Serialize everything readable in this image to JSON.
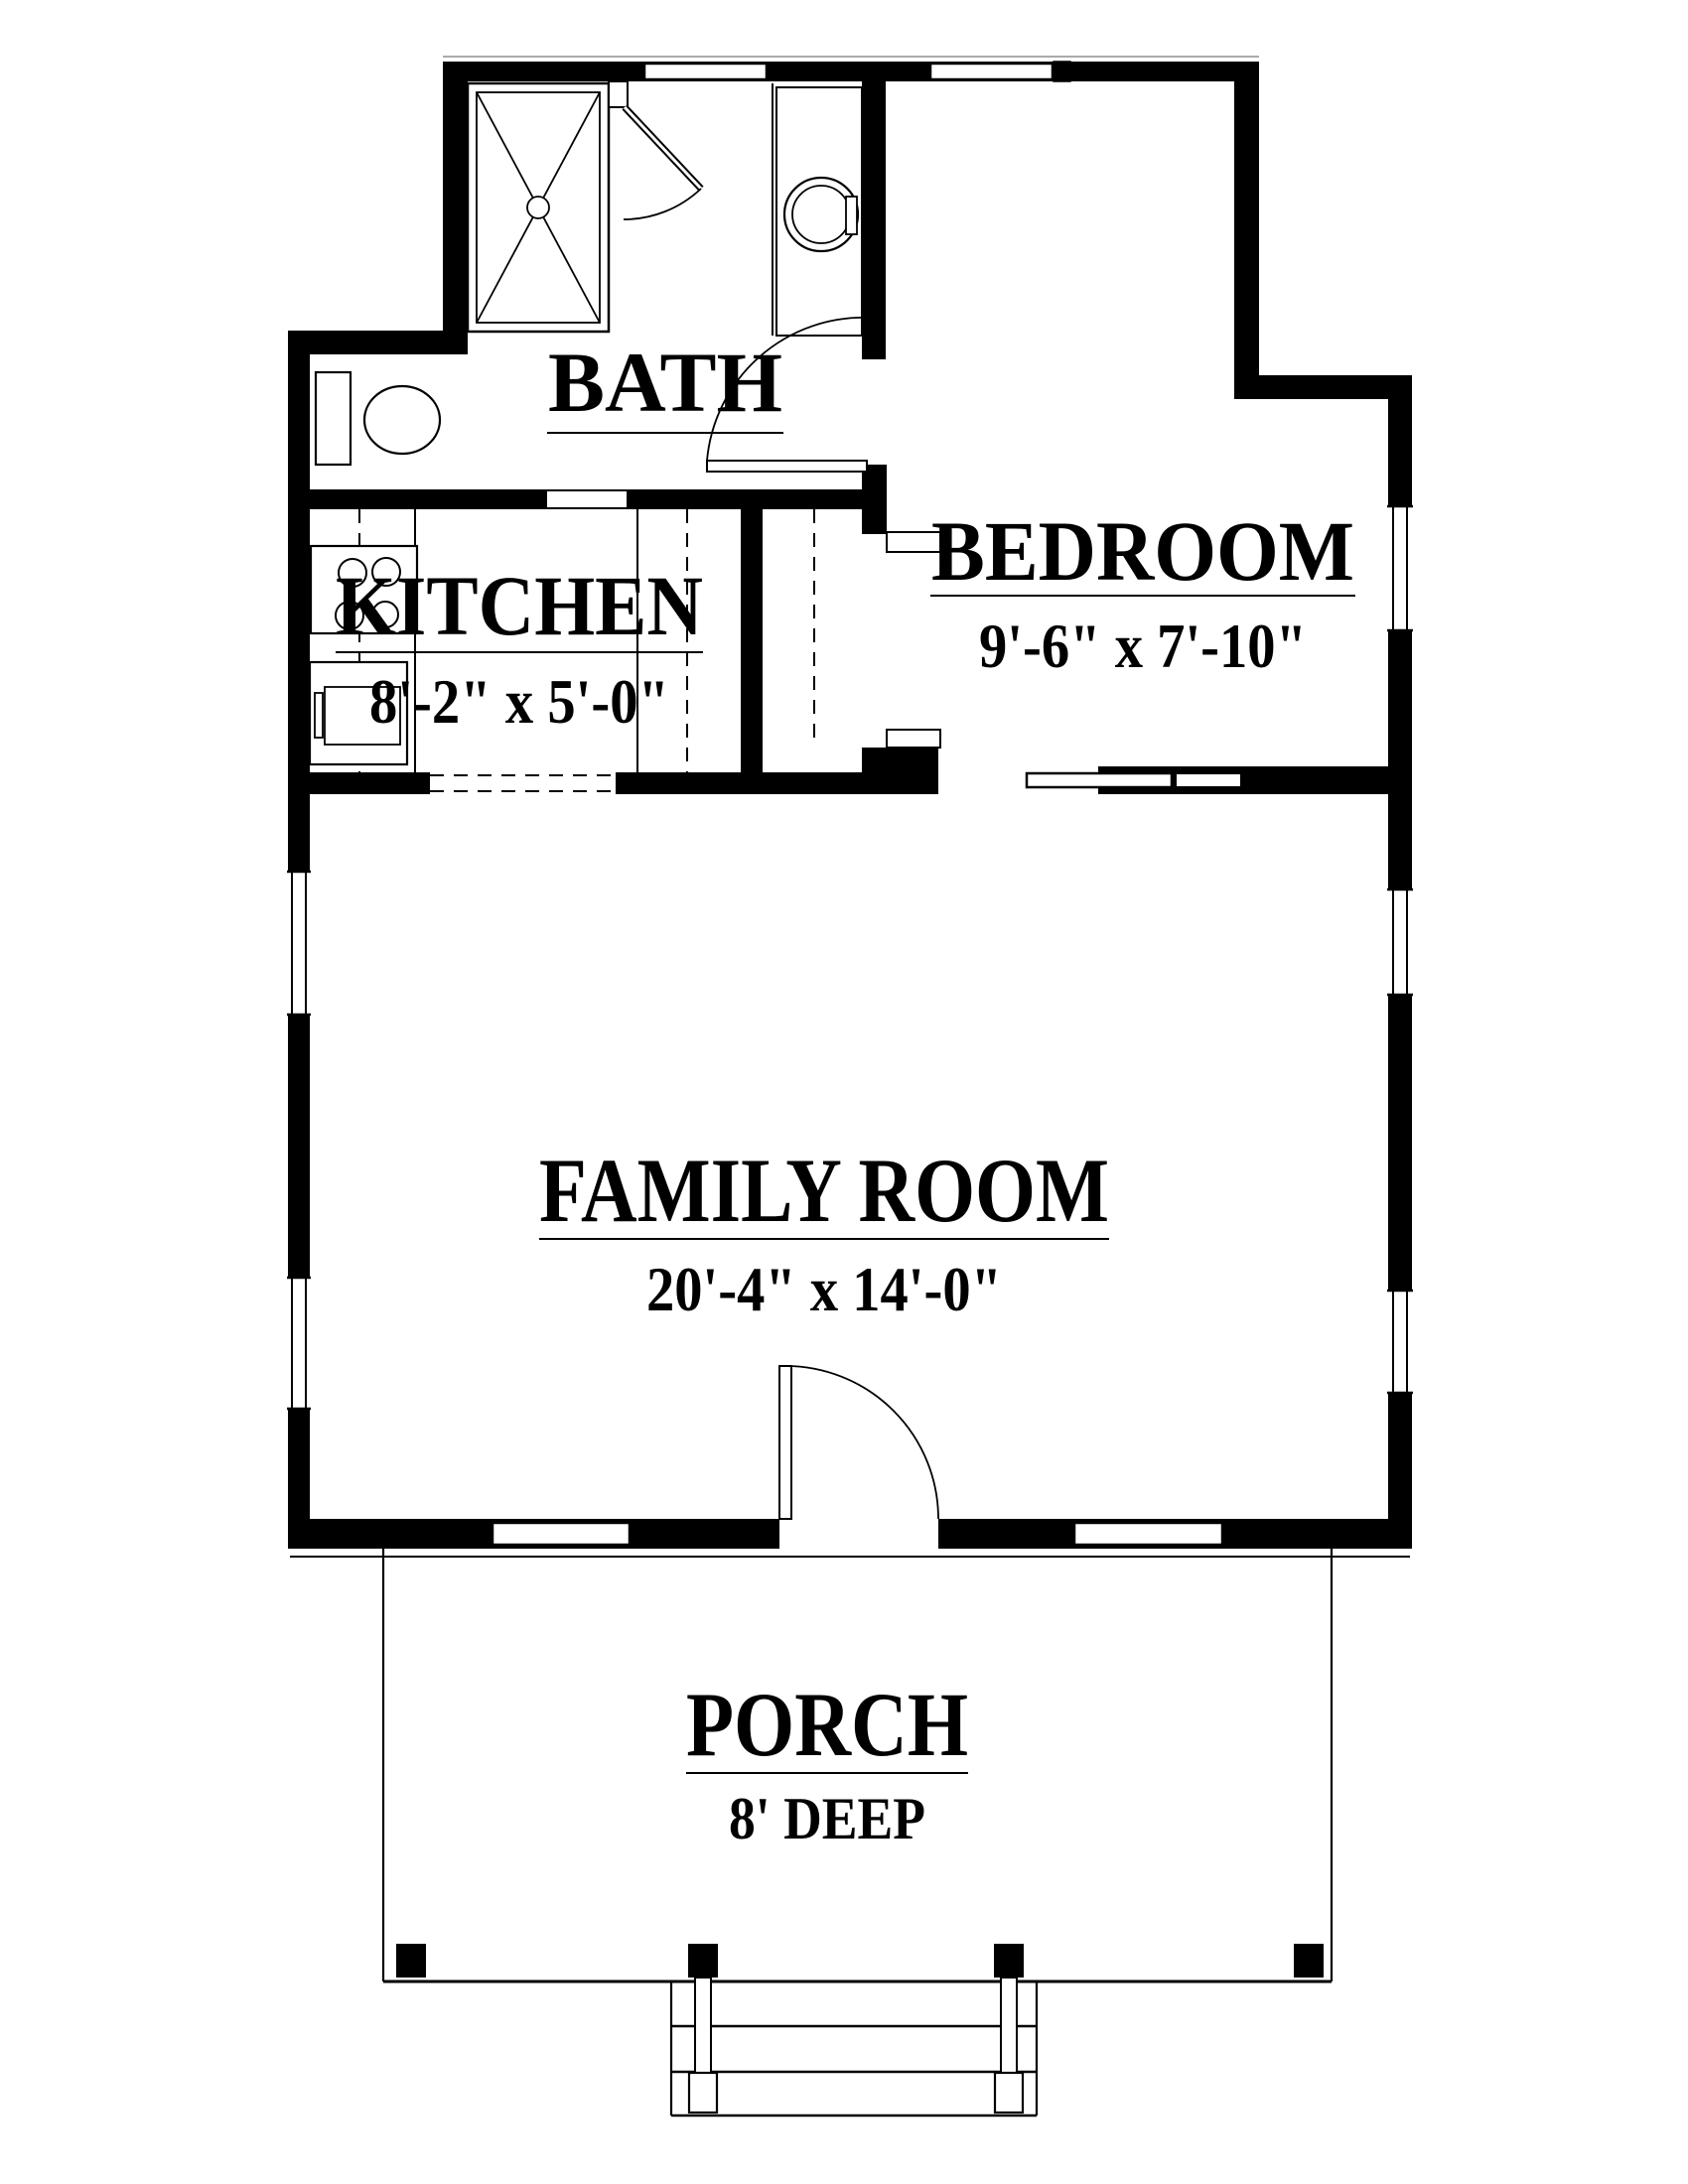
{
  "title": "one-bedroom cottage floor plan",
  "colors": {
    "line": "#000000",
    "background": "#ffffff",
    "eave_line": "#aaaaaa"
  },
  "rooms": [
    {
      "id": "bath",
      "name": "BATH",
      "dimensions": ""
    },
    {
      "id": "kitchen",
      "name": "KITCHEN",
      "dimensions": "8'-2\" x 5'-0\""
    },
    {
      "id": "bedroom",
      "name": "BEDROOM",
      "dimensions": "9'-6\" x 7'-10\""
    },
    {
      "id": "family",
      "name": "FAMILY ROOM",
      "dimensions": "20'-4\" x 14'-0\""
    },
    {
      "id": "porch",
      "name": "PORCH",
      "dimensions": "8' DEEP"
    }
  ],
  "fixtures": [
    "shower-icon",
    "shower-door-icon",
    "washer-icon",
    "toilet-icon",
    "stove-icon",
    "refrigerator-icon",
    "pocket-door-icon",
    "swing-door-icon",
    "front-door-icon",
    "closet-rod-dashed",
    "porch-posts",
    "stairs-icon",
    "window-icon",
    "wall-hatch-icon"
  ]
}
